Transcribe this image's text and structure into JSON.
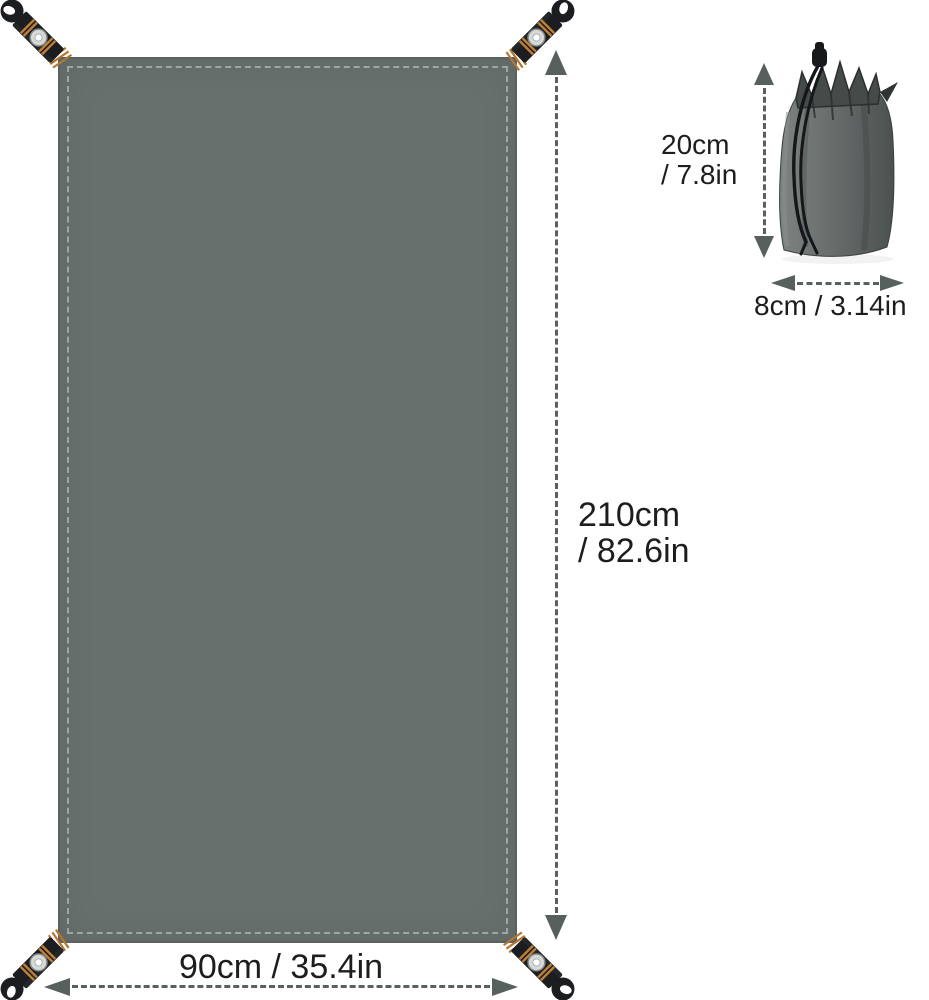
{
  "diagram_title": "groundsheet-tarp-dimension-diagram",
  "tarp": {
    "height": {
      "line1": "210cm",
      "line2": "/ 82.6in"
    },
    "width": "90cm / 35.4in"
  },
  "bag": {
    "height": {
      "line1": "20cm",
      "line2": "/ 7.8in"
    },
    "width": "8cm / 3.14in"
  },
  "colors": {
    "background": "#ffffff",
    "tarp_fill": "#67706d",
    "tarp_edge": "#59625f",
    "stitch_thread": "#bec6c2",
    "strap_webbing": "#1b1d20",
    "stitch_orange": "#c08038",
    "grommet_silver": "#d6d9d7",
    "arrow_gray": "#57605d",
    "bag_fill_light": "#7b817f",
    "bag_fill_dark": "#4f5553",
    "cord_black": "#15171a",
    "text": "#1c1e1d"
  }
}
